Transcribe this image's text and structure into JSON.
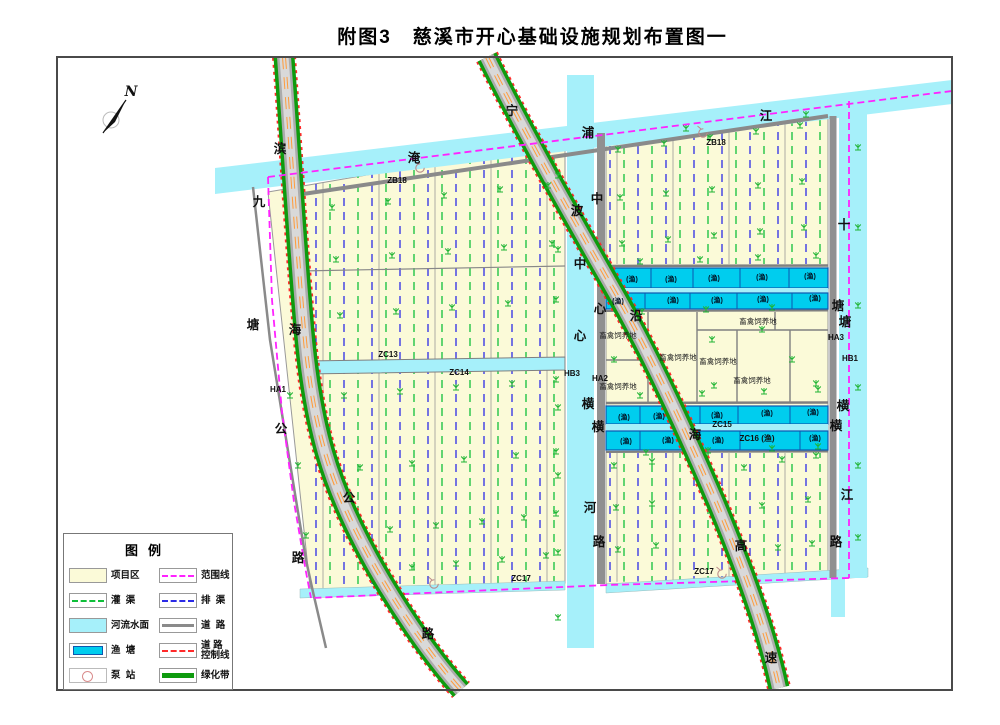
{
  "title": "附图3　慈溪市开心基础设施规划布置图一",
  "compass": {
    "label": "N"
  },
  "legend": {
    "title": "图例",
    "col1": [
      {
        "label": "项目区",
        "type": "area-cream"
      },
      {
        "label": "灌  渠",
        "type": "dash-green"
      },
      {
        "label": "河流水面",
        "type": "area-river"
      },
      {
        "label": "渔  塘",
        "type": "pond"
      },
      {
        "label": "泵  站",
        "type": "pump"
      }
    ],
    "col2": [
      {
        "label": "范围线",
        "type": "dash-magenta"
      },
      {
        "label": "排  渠",
        "type": "dash-blue"
      },
      {
        "label": "道  路",
        "type": "line-road"
      },
      {
        "label": "道 路",
        "label2": "控制线",
        "type": "dash-red"
      },
      {
        "label": "绿化带",
        "type": "line-green"
      }
    ]
  },
  "map": {
    "colors": {
      "project": "#FBFAD8",
      "river": "#A6F0FA",
      "pond": "#00CDEE",
      "pond_border": "#0C58B0",
      "canal_green": "#0FBF3A",
      "canal_blue": "#2B2BE6",
      "boundary": "#FF22FF",
      "road_gray": "#9A9A9A",
      "green_belt": "#0E9B0E",
      "control_red": "#FF2A2A",
      "center_orange": "#FF9C3C",
      "plant_green": "#1FB433"
    },
    "name_chars": [
      {
        "t": "滨",
        "x": 280,
        "y": 149
      },
      {
        "t": "海",
        "x": 295,
        "y": 330
      },
      {
        "t": "公",
        "x": 349,
        "y": 498
      },
      {
        "t": "路",
        "x": 428,
        "y": 634
      },
      {
        "t": "九",
        "x": 259,
        "y": 202
      },
      {
        "t": "塘",
        "x": 253,
        "y": 325
      },
      {
        "t": "公",
        "x": 281,
        "y": 429
      },
      {
        "t": "路",
        "x": 298,
        "y": 558
      },
      {
        "t": "宁",
        "x": 512,
        "y": 111
      },
      {
        "t": "波",
        "x": 577,
        "y": 211
      },
      {
        "t": "沿",
        "x": 636,
        "y": 316
      },
      {
        "t": "海",
        "x": 695,
        "y": 435
      },
      {
        "t": "高",
        "x": 741,
        "y": 546
      },
      {
        "t": "速",
        "x": 771,
        "y": 658
      },
      {
        "t": "淹",
        "x": 414,
        "y": 158
      },
      {
        "t": "浦",
        "x": 588,
        "y": 133
      },
      {
        "t": "江",
        "x": 766,
        "y": 116
      },
      {
        "t": "中",
        "x": 580,
        "y": 264
      },
      {
        "t": "心",
        "x": 580,
        "y": 336
      },
      {
        "t": "横",
        "x": 588,
        "y": 404
      },
      {
        "t": "河",
        "x": 590,
        "y": 508
      },
      {
        "t": "中",
        "x": 597,
        "y": 199
      },
      {
        "t": "心",
        "x": 600,
        "y": 309
      },
      {
        "t": "横",
        "x": 598,
        "y": 427
      },
      {
        "t": "路",
        "x": 599,
        "y": 542
      },
      {
        "t": "十",
        "x": 844,
        "y": 225
      },
      {
        "t": "塘",
        "x": 845,
        "y": 322
      },
      {
        "t": "横",
        "x": 843,
        "y": 406
      },
      {
        "t": "江",
        "x": 847,
        "y": 495
      },
      {
        "t": "塘",
        "x": 838,
        "y": 306
      },
      {
        "t": "横",
        "x": 836,
        "y": 426
      },
      {
        "t": "路",
        "x": 836,
        "y": 542
      }
    ],
    "code_labels": [
      {
        "t": "ZB18",
        "x": 397,
        "y": 180
      },
      {
        "t": "ZB18",
        "x": 716,
        "y": 142
      },
      {
        "t": "ZC13",
        "x": 388,
        "y": 354
      },
      {
        "t": "ZC14",
        "x": 459,
        "y": 372
      },
      {
        "t": "ZC15",
        "x": 722,
        "y": 424
      },
      {
        "t": "ZC16 (渔)",
        "x": 757,
        "y": 438
      },
      {
        "t": "ZC17",
        "x": 521,
        "y": 578
      },
      {
        "t": "ZC17",
        "x": 704,
        "y": 571
      },
      {
        "t": "HA1",
        "x": 278,
        "y": 389
      },
      {
        "t": "HA2",
        "x": 600,
        "y": 378
      },
      {
        "t": "HB3",
        "x": 572,
        "y": 373
      },
      {
        "t": "HA3",
        "x": 836,
        "y": 337
      },
      {
        "t": "HB1",
        "x": 850,
        "y": 358
      }
    ],
    "pond_label": "(渔)",
    "pond_cells": [
      {
        "x": 632,
        "y": 279
      },
      {
        "x": 671,
        "y": 279
      },
      {
        "x": 714,
        "y": 278
      },
      {
        "x": 762,
        "y": 277
      },
      {
        "x": 810,
        "y": 276
      },
      {
        "x": 618,
        "y": 301
      },
      {
        "x": 673,
        "y": 300
      },
      {
        "x": 717,
        "y": 300
      },
      {
        "x": 763,
        "y": 299
      },
      {
        "x": 815,
        "y": 298
      },
      {
        "x": 624,
        "y": 417
      },
      {
        "x": 659,
        "y": 416
      },
      {
        "x": 717,
        "y": 415
      },
      {
        "x": 767,
        "y": 413
      },
      {
        "x": 813,
        "y": 412
      },
      {
        "x": 626,
        "y": 441
      },
      {
        "x": 668,
        "y": 440
      },
      {
        "x": 718,
        "y": 440
      },
      {
        "x": 815,
        "y": 438
      }
    ],
    "livestock_label": "畜禽饲养地",
    "livestock_positions": [
      {
        "x": 618,
        "y": 335
      },
      {
        "x": 618,
        "y": 386
      },
      {
        "x": 678,
        "y": 357
      },
      {
        "x": 718,
        "y": 361
      },
      {
        "x": 758,
        "y": 321
      },
      {
        "x": 752,
        "y": 380
      }
    ]
  }
}
